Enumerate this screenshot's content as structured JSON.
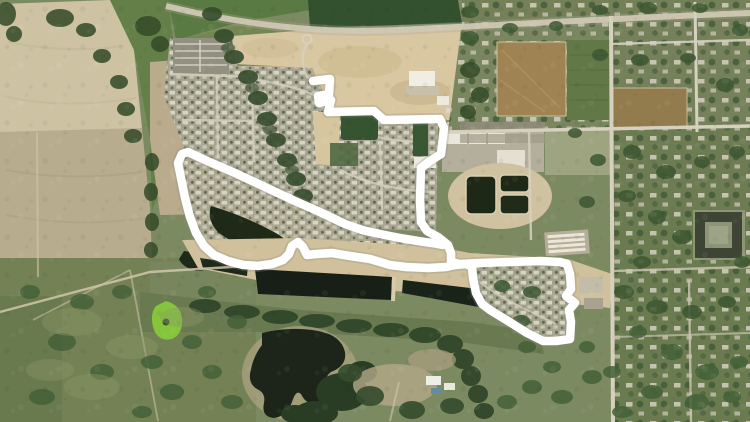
{
  "canvas": {
    "width": 750,
    "height": 422
  },
  "scene": {
    "kind": "satellite-aerial-photo-with-drawn-route",
    "features": [
      "farm-fields-west",
      "creek-treeline",
      "subdivision-north",
      "subdivision-crescent",
      "crescent-pond",
      "construction-dirt",
      "dark-green-field",
      "highway-corridor",
      "treatment-ponds",
      "commercial-buildings",
      "car-lot",
      "rv-storage",
      "irrigation-canal",
      "riparian-trees",
      "lake",
      "bright-green-pond",
      "town-grid-east",
      "apartment-complex",
      "subdivision-east-loop",
      "route-overlay"
    ]
  },
  "route": {
    "color": "#ffffff",
    "halo_color": "#8d8d84",
    "halo_opacity": 0.28,
    "stroke_width": 8.5,
    "halo_width": 12,
    "points": [
      [
        313,
        81
      ],
      [
        330,
        79
      ],
      [
        329,
        94
      ],
      [
        318,
        96
      ],
      [
        319,
        103
      ],
      [
        331,
        100
      ],
      [
        328,
        112
      ],
      [
        374,
        111
      ],
      [
        384,
        120
      ],
      [
        440,
        119
      ],
      [
        444,
        128
      ],
      [
        441,
        154
      ],
      [
        430,
        161
      ],
      [
        421,
        168
      ],
      [
        420,
        200
      ],
      [
        421,
        222
      ],
      [
        427,
        231
      ],
      [
        438,
        237
      ],
      [
        448,
        245
      ],
      [
        451,
        253
      ],
      [
        451,
        262
      ],
      [
        460,
        264
      ],
      [
        480,
        263
      ],
      [
        510,
        262
      ],
      [
        540,
        261
      ],
      [
        560,
        262
      ],
      [
        567,
        264
      ],
      [
        570,
        274
      ],
      [
        571,
        289
      ],
      [
        566,
        296
      ],
      [
        575,
        303
      ],
      [
        569,
        310
      ],
      [
        571,
        322
      ],
      [
        570,
        339
      ],
      [
        556,
        341
      ],
      [
        543,
        341
      ],
      [
        527,
        333
      ],
      [
        508,
        321
      ],
      [
        490,
        310
      ],
      [
        482,
        304
      ],
      [
        476,
        293
      ],
      [
        473,
        278
      ],
      [
        472,
        267
      ],
      [
        466,
        264
      ],
      [
        455,
        265
      ],
      [
        446,
        267
      ],
      [
        428,
        268
      ],
      [
        406,
        267
      ],
      [
        390,
        265
      ],
      [
        370,
        259
      ],
      [
        350,
        256
      ],
      [
        332,
        253
      ],
      [
        316,
        254
      ],
      [
        307,
        255
      ],
      [
        303,
        247
      ],
      [
        298,
        242
      ],
      [
        292,
        246
      ],
      [
        289,
        254
      ],
      [
        283,
        260
      ],
      [
        272,
        264
      ],
      [
        258,
        266
      ],
      [
        243,
        265
      ],
      [
        228,
        261
      ],
      [
        214,
        255
      ],
      [
        204,
        246
      ],
      [
        196,
        233
      ],
      [
        190,
        217
      ],
      [
        185,
        198
      ],
      [
        181,
        178
      ],
      [
        178,
        163
      ],
      [
        182,
        154
      ],
      [
        188,
        152
      ],
      [
        205,
        160
      ],
      [
        235,
        173
      ],
      [
        265,
        187
      ],
      [
        295,
        201
      ],
      [
        322,
        213
      ],
      [
        345,
        224
      ],
      [
        362,
        230
      ],
      [
        380,
        234
      ],
      [
        400,
        238
      ],
      [
        418,
        241
      ],
      [
        432,
        243
      ],
      [
        443,
        245
      ]
    ]
  },
  "palette": {
    "route": "#ffffff",
    "water_dark": "#10180e",
    "field_tan": "#ccc1a1",
    "scrub_tan": "#b7a888",
    "green_dark": "#2b4926",
    "green_olive": "#6d7c4e",
    "dirt_sand": "#d7c69f",
    "road_light": "#d5cfbe",
    "bright_green": "#7fc334"
  }
}
